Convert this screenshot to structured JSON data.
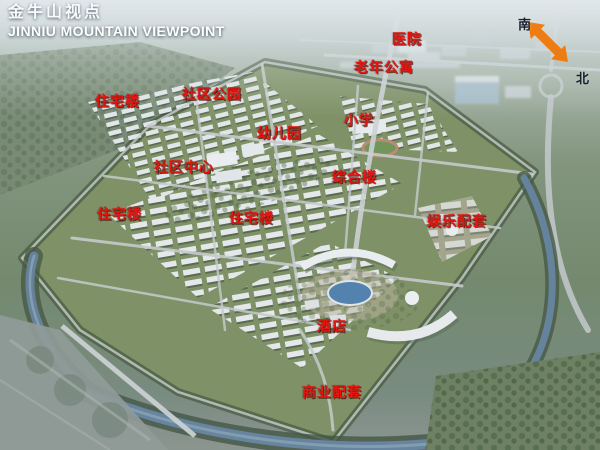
{
  "title": {
    "chinese": "金牛山视点",
    "english": "JINNIU MOUNTAIN VIEWPOINT"
  },
  "compass": {
    "south": "南",
    "north": "北"
  },
  "map_labels": [
    {
      "text": "医院",
      "x": 392,
      "y": 29
    },
    {
      "text": "老年公寓",
      "x": 354,
      "y": 57
    },
    {
      "text": "社区公园",
      "x": 182,
      "y": 84
    },
    {
      "text": "住宅楼",
      "x": 95,
      "y": 91
    },
    {
      "text": "小学",
      "x": 344,
      "y": 110
    },
    {
      "text": "幼儿园",
      "x": 257,
      "y": 123
    },
    {
      "text": "社区中心",
      "x": 154,
      "y": 157
    },
    {
      "text": "综合楼",
      "x": 332,
      "y": 167
    },
    {
      "text": "住宅楼",
      "x": 97,
      "y": 204
    },
    {
      "text": "住宅楼",
      "x": 229,
      "y": 208
    },
    {
      "text": "娱乐配套",
      "x": 427,
      "y": 211
    },
    {
      "text": "酒店",
      "x": 317,
      "y": 316
    },
    {
      "text": "商业配套",
      "x": 302,
      "y": 382
    }
  ],
  "colors": {
    "label_red": "#e8140e",
    "compass_arrow": "#ee7c14",
    "title_text": "#ffffff"
  }
}
